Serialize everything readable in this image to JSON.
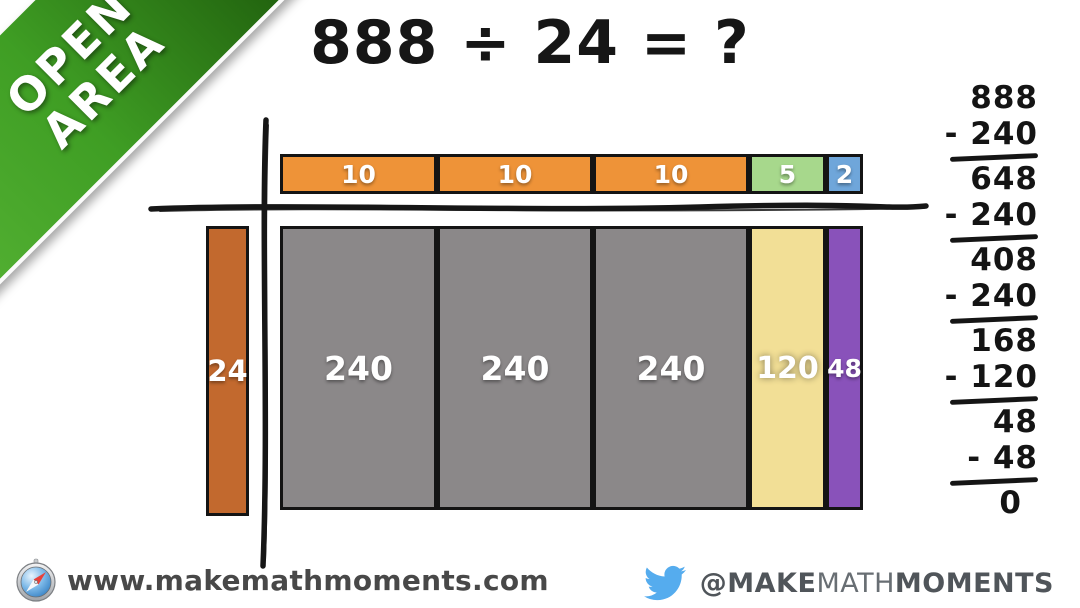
{
  "ribbon": {
    "line1": "OPEN",
    "line2": "AREA",
    "color_light": "#57b435",
    "color_dark": "#1a5409"
  },
  "title": "888 ÷ 24 = ?",
  "area_model": {
    "divisor": {
      "label": "24",
      "color": "#C2692E"
    },
    "quotient_row": [
      {
        "label": "10",
        "color": "#EE9338"
      },
      {
        "label": "10",
        "color": "#EE9338"
      },
      {
        "label": "10",
        "color": "#EE9338"
      },
      {
        "label": "5",
        "color": "#A7D88C"
      },
      {
        "label": "2",
        "color": "#6FA6DA"
      }
    ],
    "product_row": [
      {
        "label": "240",
        "color": "#8B8889"
      },
      {
        "label": "240",
        "color": "#8B8889"
      },
      {
        "label": "240",
        "color": "#8B8889"
      },
      {
        "label": "120",
        "color": "#F2DF96"
      },
      {
        "label": "48",
        "color": "#8952BA"
      }
    ]
  },
  "subtraction": {
    "lines": [
      "888",
      "- 240",
      "648",
      "- 240",
      "408",
      "- 240",
      "168",
      "- 120",
      "48",
      "- 48",
      "0"
    ]
  },
  "footer": {
    "website": "www.makemathmoments.com",
    "handle_at": "@MAKE",
    "handle_mid": "MATH",
    "handle_end": "MOMENTS",
    "twitter_blue": "#55ACEE"
  }
}
